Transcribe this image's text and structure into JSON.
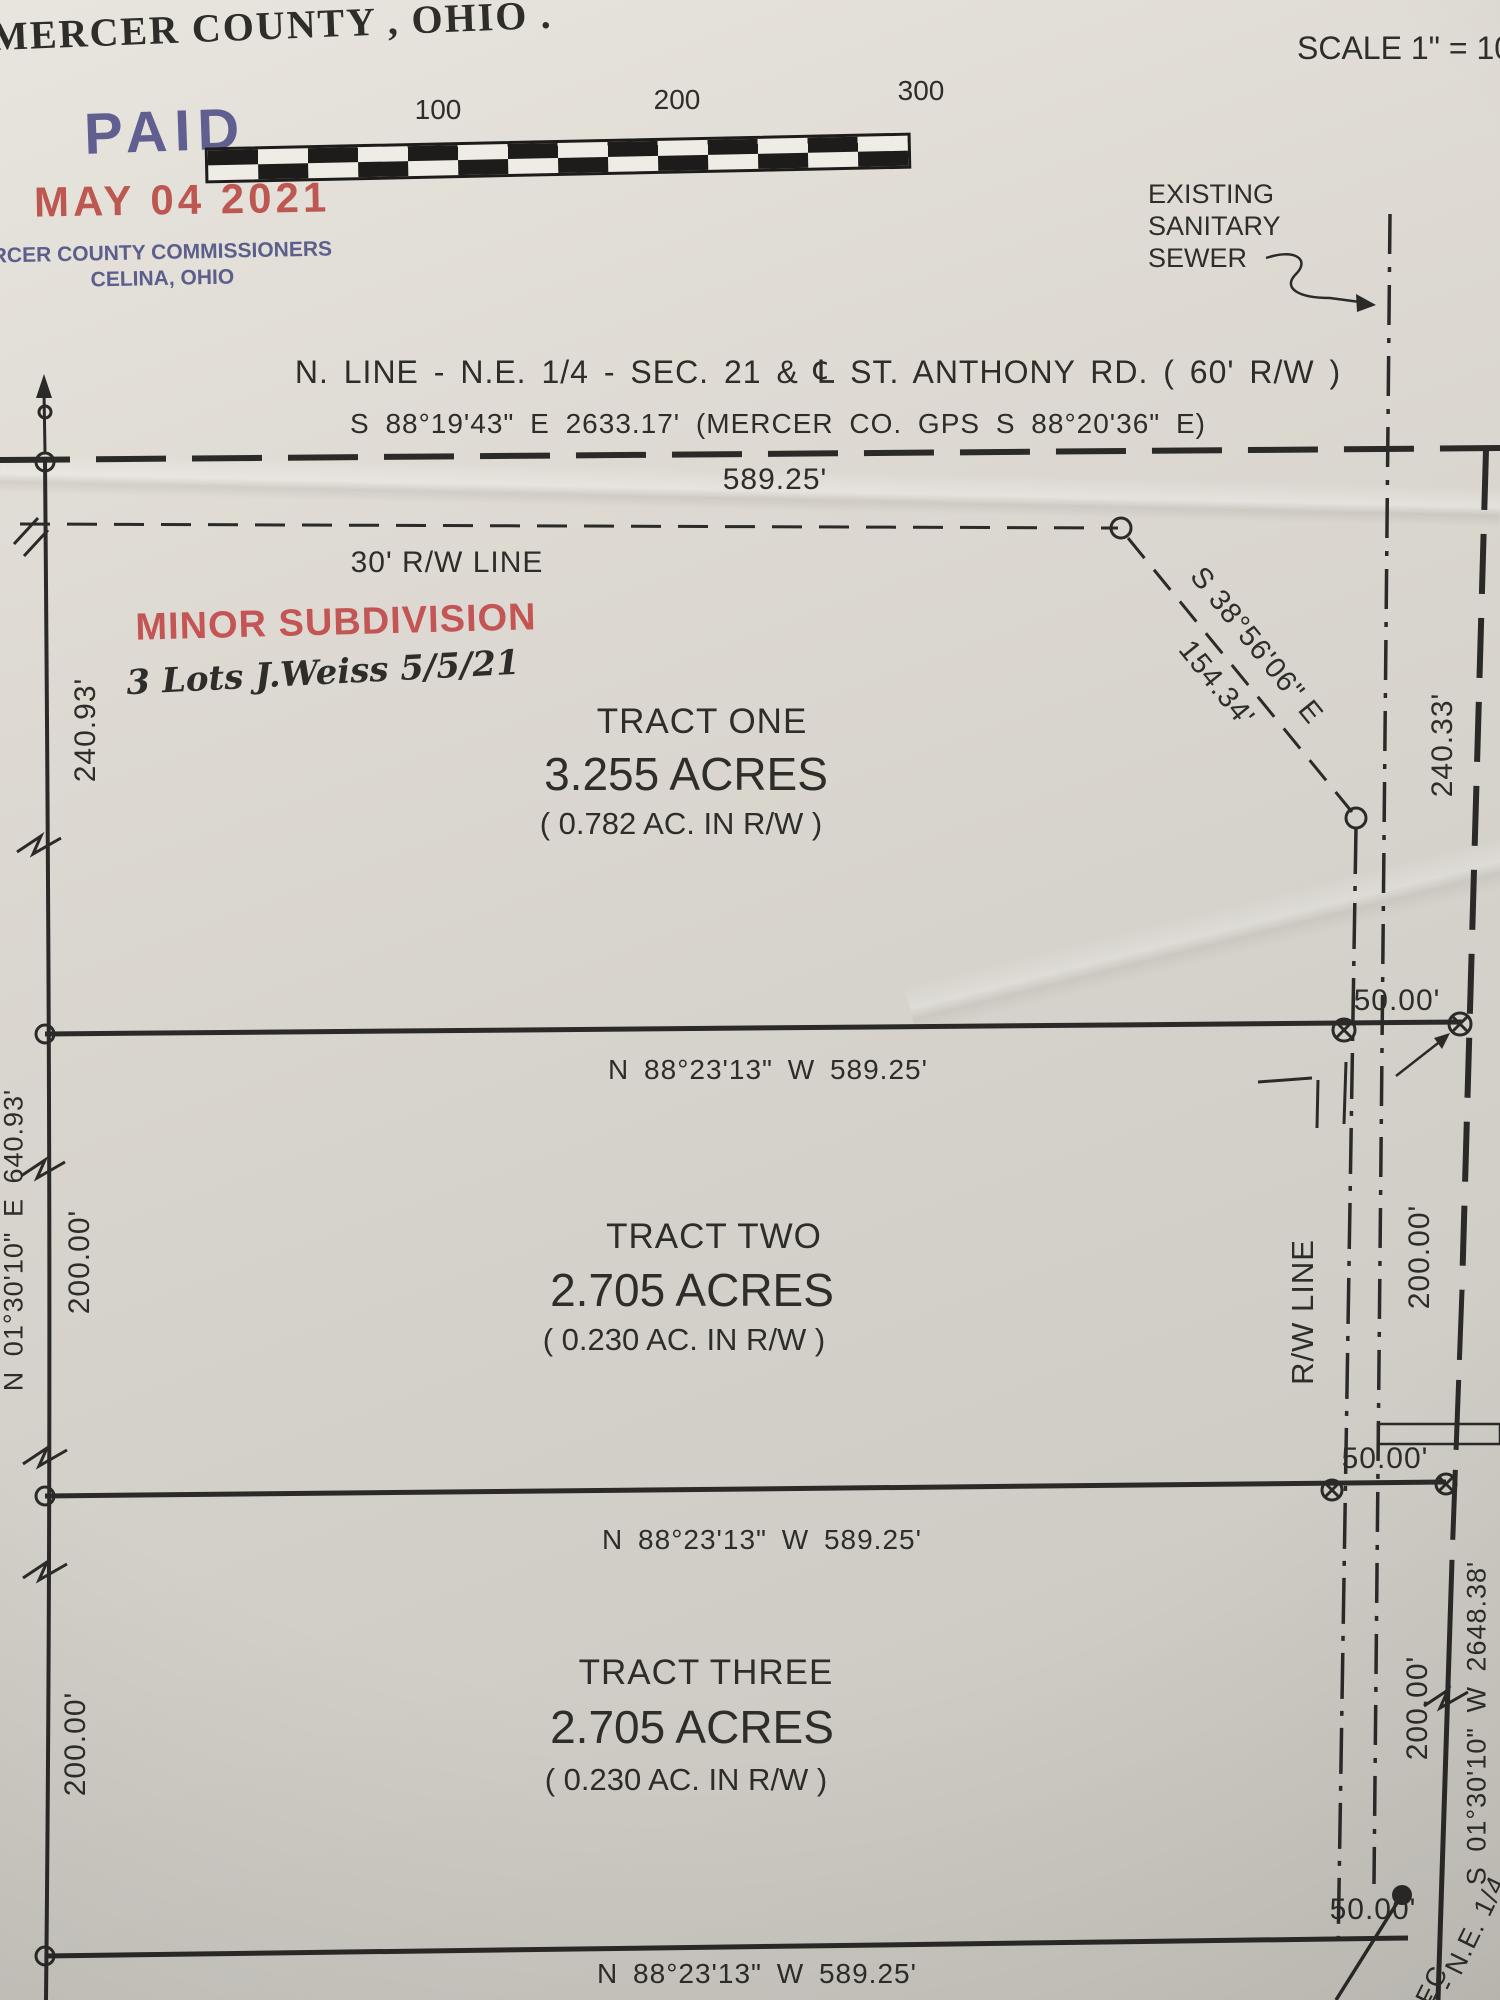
{
  "page": {
    "title": "MERCER COUNTY , OHIO .",
    "scale_note": "SCALE 1\" = 10"
  },
  "stamps": {
    "paid": "PAID",
    "date": "MAY 04 2021",
    "comm1": "RCER COUNTY COMMISSIONERS",
    "comm2": "CELINA, OHIO"
  },
  "scale_bar": {
    "labels": [
      "100",
      "200",
      "300"
    ]
  },
  "sewer": {
    "l1": "EXISTING",
    "l2": "SANITARY",
    "l3": "SEWER"
  },
  "heading": {
    "l1": "N. LINE - N.E. 1/4 - SEC. 21   &   ℄   ST. ANTHONY RD. ( 60' R/W )",
    "l2": "S 88°19'43\" E   2633.17'   (MERCER CO. GPS S 88°20'36\" E)"
  },
  "notes": {
    "rw30": "30' R/W LINE",
    "minor": "MINOR SUBDIVISION",
    "hand": "3 Lots J.Weiss  5/5/21"
  },
  "tracts": [
    {
      "name": "TRACT ONE",
      "acres": "3.255 ACRES",
      "rw": "( 0.782 AC. IN R/W )"
    },
    {
      "name": "TRACT TWO",
      "acres": "2.705 ACRES",
      "rw": "( 0.230 AC. IN R/W )"
    },
    {
      "name": "TRACT THREE",
      "acres": "2.705 ACRES",
      "rw": "( 0.230 AC. IN R/W )"
    }
  ],
  "dims": {
    "top_589": "589.25'",
    "south_bearing": "N 88°23'13\" W    589.25'",
    "left_240": "240.93'",
    "left_long": "N 01°30'10\" E   640.93'",
    "left_200a": "200.00'",
    "left_200b": "200.00'",
    "diag_bearing": "S 38°56'06\" E",
    "diag_len": "154.34'",
    "right_240": "240.33'",
    "right_200a": "200.00'",
    "right_200b": "200.00'",
    "fifty": "50.00'",
    "rw_label": "R/W LINE",
    "right_long": "S 01°30'10\" W   2648.38'",
    "corner_a": "E - N.E. 1/4",
    "corner_b": "SEC"
  }
}
